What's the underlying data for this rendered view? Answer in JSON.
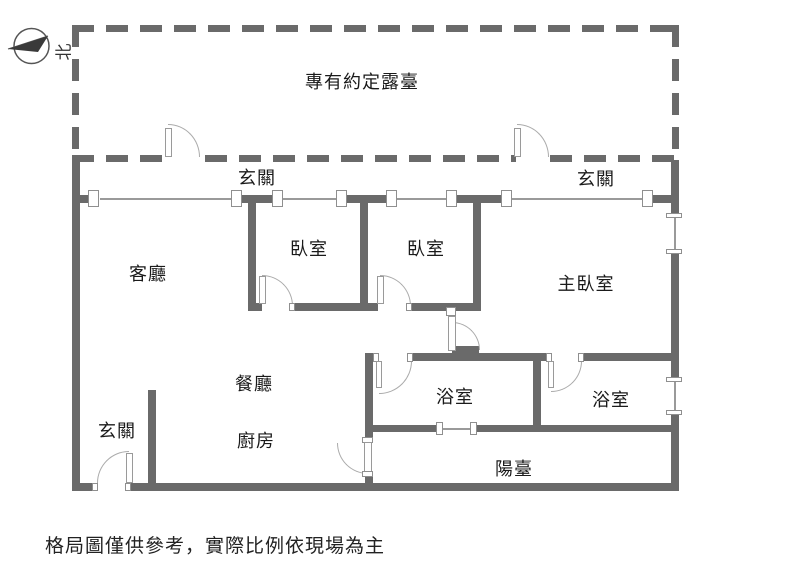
{
  "compass": {
    "north_label": "北"
  },
  "terrace": {
    "label": "專有約定露臺"
  },
  "rooms": {
    "entry_top_left": {
      "label": "玄關"
    },
    "entry_top_right": {
      "label": "玄關"
    },
    "living": {
      "label": "客廳"
    },
    "bedroom1": {
      "label": "臥室"
    },
    "bedroom2": {
      "label": "臥室"
    },
    "master_bedroom": {
      "label": "主臥室"
    },
    "dining": {
      "label": "餐廳"
    },
    "entry_bottom": {
      "label": "玄關"
    },
    "kitchen": {
      "label": "廚房"
    },
    "bathroom1": {
      "label": "浴室"
    },
    "bathroom2": {
      "label": "浴室"
    },
    "balcony": {
      "label": "陽臺"
    }
  },
  "footnote": "格局圖僅供參考，實際比例依現場為主",
  "colors": {
    "wall": "#6a6a6a",
    "window_line": "#9a9a9a",
    "door_arc": "#ababab",
    "text": "#1a1a1a"
  }
}
